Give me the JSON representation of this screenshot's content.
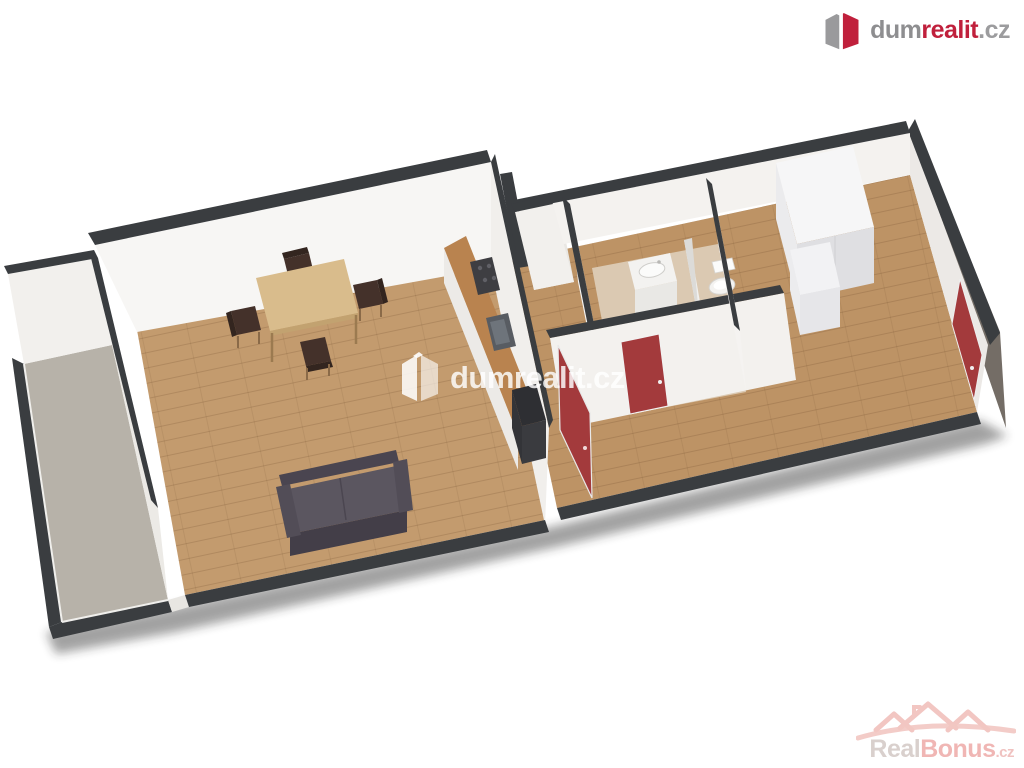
{
  "branding": {
    "header_logo": {
      "prefix": "dum",
      "accent": "realit",
      "suffix": ".cz",
      "prefix_color": "#8e8e90",
      "accent_color": "#c0203c",
      "suffix_color": "#9c9c9e",
      "icon": "dumrealit-box-icon"
    },
    "center_watermark": {
      "text": "dumrealit.cz",
      "color": "rgba(255,255,255,0.82)",
      "icon": "dumrealit-box-icon"
    },
    "footer_watermark": {
      "prefix": "Real",
      "accent": "Bonus",
      "suffix": ".cz",
      "prefix_color": "#d9d0cd",
      "accent_color": "#f0b6b4",
      "suffix_color": "#f0c2c0",
      "icon": "house-roofline-icon"
    }
  },
  "floor_plan": {
    "view": "3d-axonometric-apartment",
    "colors": {
      "wall_top": "#3a3d40",
      "wall_face": "#f6f5f3",
      "outer_wall": "#746d66",
      "wood_floor": "#c39b6e",
      "hall_wood_floor": "#bd9365",
      "balcony_floor": "#b7b2a9",
      "bathroom_floor": "#dbc9b2",
      "door_red": "#a33a3c",
      "counter_wood": "#b9834f",
      "table_wood": "#d9bc8c",
      "chair_brown": "#44312a",
      "sofa_gray": "#5b5660"
    },
    "rooms": [
      {
        "name": "balcony",
        "floor": "gray-concrete",
        "furniture": []
      },
      {
        "name": "living-room",
        "floor": "wood",
        "furniture": [
          "dining-table",
          "four-chairs",
          "sofa",
          "kitchen-counter-with-cooktop-sink-and-tall-oven-unit"
        ]
      },
      {
        "name": "entry-closet",
        "floor": "white",
        "furniture": []
      },
      {
        "name": "bathroom",
        "floor": "beige-tile",
        "furniture": [
          "washing-machine",
          "washbasin",
          "toilet-behind-partition"
        ]
      },
      {
        "name": "hallway",
        "floor": "wood",
        "furniture": []
      },
      {
        "name": "bedroom",
        "floor": "wood",
        "furniture": [
          "white-wardrobe"
        ]
      }
    ],
    "doors": [
      {
        "name": "living-room-to-hallway",
        "state": "open",
        "color": "red"
      },
      {
        "name": "bathroom-door",
        "state": "closed",
        "color": "red"
      },
      {
        "name": "bedroom-east-door",
        "state": "closed",
        "color": "red"
      }
    ]
  }
}
